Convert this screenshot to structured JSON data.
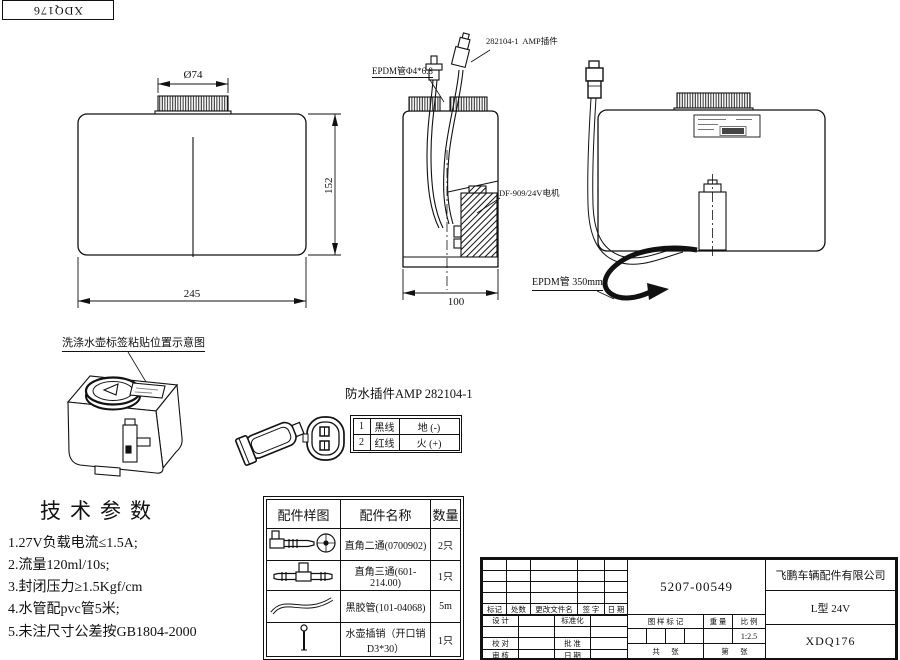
{
  "corner_code": "XDQ176",
  "views": {
    "front": {
      "dim_cap_dia": "Ø74",
      "dim_height": "152",
      "dim_width": "245"
    },
    "side": {
      "dim_width": "100",
      "label_tube": "EPDM管Φ4*6.8",
      "label_connector": "282104-1  AMP插件",
      "label_motor": "DF-909/24V电机"
    },
    "rear": {
      "label_hose": "EPDM管 350mm"
    }
  },
  "iso_view": {
    "title": "洗涤水壶标签粘贴位置示意图"
  },
  "connector_section": {
    "title": "防水插件AMP 282104-1",
    "pinout": [
      {
        "pin": "1",
        "wire": "黑线",
        "function": "地 (-)"
      },
      {
        "pin": "2",
        "wire": "红线",
        "function": "火 (+)"
      }
    ]
  },
  "tech_params": {
    "title": "技术参数",
    "items": [
      "1.27V负载电流≤1.5A;",
      "2.流量120ml/10s;",
      "3.封闭压力≥1.5Kgf/cm",
      "4.水管配pvc管5米;",
      "5.未注尺寸公差按GB1804-2000"
    ]
  },
  "parts_table": {
    "headers": [
      "配件样图",
      "配件名称",
      "数量"
    ],
    "rows": [
      {
        "name": "直角二通(0700902)",
        "qty": "2只"
      },
      {
        "name": "直角三通(601-214.00)",
        "qty": "1只"
      },
      {
        "name": "黑胶管(101-04068)",
        "qty": "5m"
      },
      {
        "name": "水壶插销（开口销\nD3*30）",
        "qty": "1只"
      }
    ]
  },
  "title_block": {
    "part_no": "5207-00549",
    "company": "飞鹏车辆配件有限公司",
    "model": "L型 24V",
    "drawing_no": "XDQ176",
    "scale": "1:2.5",
    "rev_headers": [
      "标记",
      "处数",
      "更改文件名",
      "签 字",
      "日 期"
    ],
    "sign_labels": [
      [
        "设 计",
        "标准化"
      ],
      [
        "校 对",
        "批 准"
      ],
      [
        "审 核",
        "日 期"
      ]
    ],
    "stamp_headers": [
      "图 样 标 记",
      "重 量",
      "比 例"
    ],
    "sheet_total": "共      张",
    "sheet_page": "第      张"
  }
}
